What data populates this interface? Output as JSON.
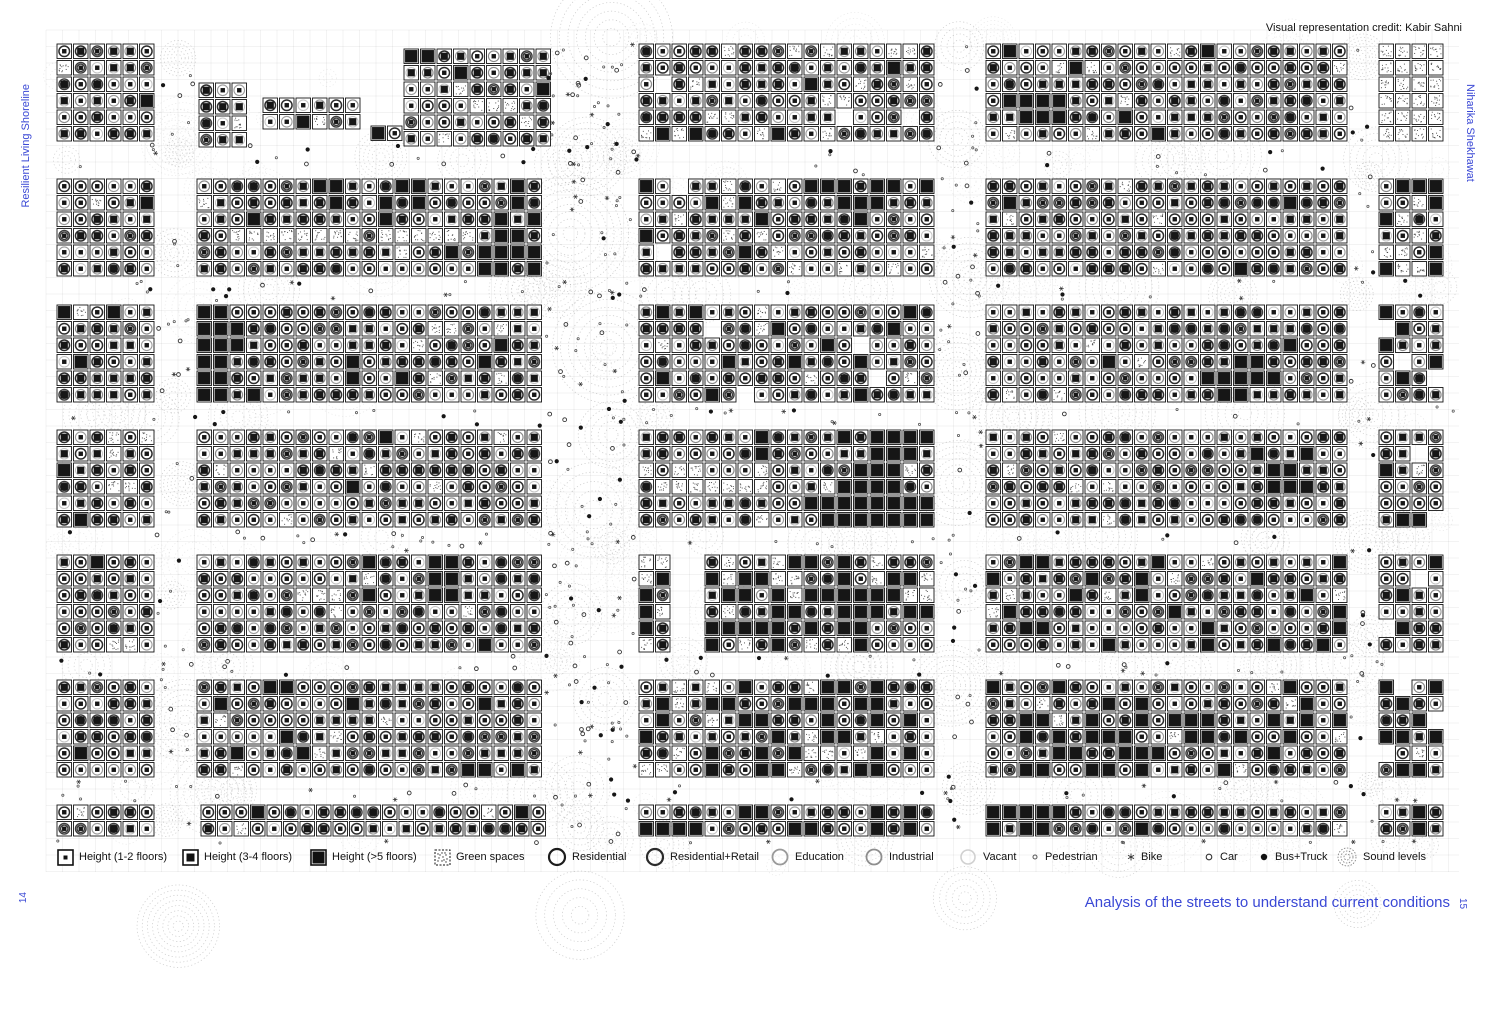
{
  "colors": {
    "accent": "#3a48d5",
    "ink": "#141414"
  },
  "page": {
    "credit": "Visual representation credit: Kabir Sahni",
    "margin_left_text": "Resilient Living Shoreline",
    "margin_right_text": "Niharika Shekhawat",
    "page_number_left": "14",
    "page_number_right": "15",
    "caption": "Analysis of the streets to understand current conditions"
  },
  "legend": {
    "items": [
      {
        "label": "Height (1-2 floors)",
        "icon": "height-low",
        "x": 57
      },
      {
        "label": "Height (3-4 floors)",
        "icon": "height-mid",
        "x": 182
      },
      {
        "label": "Height (>5 floors)",
        "icon": "height-high",
        "x": 310
      },
      {
        "label": "Green spaces",
        "icon": "green-spaces",
        "x": 434
      },
      {
        "label": "Residential",
        "icon": "residential",
        "x": 547
      },
      {
        "label": "Residential+Retail",
        "icon": "residential-retail",
        "x": 645
      },
      {
        "label": "Education",
        "icon": "education",
        "x": 770
      },
      {
        "label": "Industrial",
        "icon": "industrial",
        "x": 864
      },
      {
        "label": "Vacant",
        "icon": "vacant",
        "x": 958
      },
      {
        "label": "Pedestrian",
        "icon": "pedestrian",
        "x": 1030
      },
      {
        "label": "Bike",
        "icon": "bike",
        "x": 1126
      },
      {
        "label": "Car",
        "icon": "car",
        "x": 1203
      },
      {
        "label": "Bus+Truck",
        "icon": "bus-truck",
        "x": 1258
      },
      {
        "label": "Sound levels",
        "icon": "sound-levels",
        "x": 1336
      }
    ]
  },
  "map": {
    "width": 1498,
    "height": 1017,
    "cell": 16.5,
    "seed": 20240608,
    "grid": {
      "x0": 46,
      "y0": 30,
      "x1": 1459,
      "y1": 872
    },
    "colors": {
      "ink": "#161616",
      "grid": "rgba(20,20,20,0.10)",
      "sound": "#8a8a8a",
      "speckle": "#2f2f2f"
    },
    "defaults": {
      "green": 0.035,
      "tall": 0.045,
      "mid": 0.47
    },
    "ring_styles": [
      {
        "p": 0.38,
        "c": "#2d2d2d",
        "w": 1.5,
        "d": false
      },
      {
        "p": 0.18,
        "c": "#3c3c3c",
        "w": 1.4,
        "d": true
      },
      {
        "p": 0.16,
        "c": "#8a8a8a",
        "w": 1.2,
        "d": false
      },
      {
        "p": 0.16,
        "c": "#9c9c9c",
        "w": 1.1,
        "d": false
      },
      {
        "p": 0.12,
        "c": "#c4c4c4",
        "w": 1.0,
        "d": false
      }
    ],
    "ambient": {
      "count": 150,
      "alpha": 0.2
    },
    "street_alpha": 0.45,
    "vstreets": [
      {
        "x0": 155,
        "x1": 196,
        "gap": 110,
        "dots": 40
      },
      {
        "x0": 543,
        "x1": 638,
        "gap": 95,
        "dots": 150
      },
      {
        "x0": 935,
        "x1": 985,
        "gap": 105,
        "dots": 60
      },
      {
        "x0": 1348,
        "x1": 1378,
        "gap": 120,
        "dots": 28
      }
    ],
    "hstreets": [
      {
        "y0": 142,
        "y1": 178,
        "n": 10,
        "dots": 40
      },
      {
        "y0": 277,
        "y1": 304,
        "n": 10,
        "dots": 40
      },
      {
        "y0": 403,
        "y1": 429,
        "n": 10,
        "dots": 40
      },
      {
        "y0": 528,
        "y1": 554,
        "n": 10,
        "dots": 40
      },
      {
        "y0": 653,
        "y1": 679,
        "n": 10,
        "dots": 40
      },
      {
        "y0": 778,
        "y1": 804,
        "n": 10,
        "dots": 40
      },
      {
        "y0": 838,
        "y1": 846,
        "n": 6,
        "dots": 14
      }
    ],
    "blocks": [
      {
        "x": 56,
        "y": 43,
        "c": 6,
        "r": 6
      },
      {
        "x": 198,
        "y": 82,
        "c": 3,
        "r": 4
      },
      {
        "x": 262,
        "y": 97,
        "c": 6,
        "r": 2
      },
      {
        "x": 370,
        "y": 125,
        "c": 2,
        "r": 1
      },
      {
        "x": 403,
        "y": 48,
        "c": 9,
        "r": 6,
        "t": 0.12,
        "clusters": [
          {
            "c": 0,
            "r": 0,
            "w": 2,
            "h": 2,
            "k": "tall",
            "d": 0.7
          },
          {
            "c": 4,
            "r": 3,
            "w": 3,
            "h": 1,
            "k": "green",
            "d": 0.8
          }
        ]
      },
      {
        "x": 638,
        "y": 43,
        "c": 18,
        "r": 6,
        "g": 0.12,
        "t": 0.1,
        "holes": 3
      },
      {
        "x": 985,
        "y": 43,
        "c": 22,
        "r": 6,
        "t": 0.06,
        "clusters": [
          {
            "c": 1,
            "r": 3,
            "w": 4,
            "h": 2,
            "k": "tall",
            "d": 0.95
          }
        ]
      },
      {
        "x": 1378,
        "y": 43,
        "c": 4,
        "r": 6,
        "g": 1
      },
      {
        "x": 56,
        "y": 178,
        "c": 6,
        "r": 6
      },
      {
        "x": 196,
        "y": 178,
        "c": 21,
        "r": 6,
        "clusters": [
          {
            "c": 2,
            "r": 3,
            "w": 16,
            "h": 1,
            "k": "green",
            "d": 0.95
          },
          {
            "c": 6,
            "r": 0,
            "w": 3,
            "h": 2,
            "k": "tall",
            "d": 0.6
          },
          {
            "c": 11,
            "r": 0,
            "w": 3,
            "h": 2,
            "k": "tall",
            "d": 0.6
          },
          {
            "c": 17,
            "r": 2,
            "w": 4,
            "h": 4,
            "k": "tall",
            "d": 0.5
          }
        ]
      },
      {
        "x": 638,
        "y": 178,
        "c": 18,
        "r": 6,
        "t": 0.1,
        "g": 0.08,
        "holes": 2,
        "clusters": [
          {
            "c": 10,
            "r": 0,
            "w": 6,
            "h": 2,
            "k": "tall",
            "d": 0.5
          }
        ]
      },
      {
        "x": 985,
        "y": 178,
        "c": 22,
        "r": 6,
        "t": 0.05,
        "g": 0.04
      },
      {
        "x": 1378,
        "y": 178,
        "c": 4,
        "r": 6,
        "t": 0.3,
        "g": 0.3
      },
      {
        "x": 56,
        "y": 304,
        "c": 6,
        "r": 6
      },
      {
        "x": 196,
        "y": 304,
        "c": 21,
        "r": 6,
        "clusters": [
          {
            "c": 0,
            "r": 0,
            "w": 2,
            "h": 6,
            "k": "tall",
            "d": 0.85
          },
          {
            "c": 2,
            "r": 1,
            "w": 1,
            "h": 3,
            "k": "tall",
            "d": 0.6
          },
          {
            "c": 14,
            "r": 1,
            "w": 4,
            "h": 1,
            "k": "green",
            "d": 0.7
          }
        ]
      },
      {
        "x": 638,
        "y": 304,
        "c": 18,
        "r": 6,
        "holes": 4,
        "t": 0.08,
        "g": 0.06,
        "clusters": [
          {
            "c": 1,
            "r": 0,
            "w": 2,
            "h": 2,
            "k": "tall",
            "d": 0.6
          }
        ]
      },
      {
        "x": 985,
        "y": 304,
        "c": 22,
        "r": 6,
        "clusters": [
          {
            "c": 13,
            "r": 3,
            "w": 4,
            "h": 3,
            "k": "tall",
            "d": 0.8
          }
        ]
      },
      {
        "x": 1378,
        "y": 304,
        "c": 4,
        "r": 6,
        "holes": 3,
        "t": 0.2
      },
      {
        "x": 56,
        "y": 429,
        "c": 6,
        "r": 6
      },
      {
        "x": 196,
        "y": 429,
        "c": 21,
        "r": 6,
        "t": 0.04,
        "g": 0.05
      },
      {
        "x": 638,
        "y": 429,
        "c": 18,
        "r": 6,
        "g": 0.12,
        "clusters": [
          {
            "c": 12,
            "r": 0,
            "w": 6,
            "h": 2,
            "k": "tall",
            "d": 0.85
          },
          {
            "c": 13,
            "r": 2,
            "w": 3,
            "h": 2,
            "k": "tall",
            "d": 0.7
          },
          {
            "c": 11,
            "r": 4,
            "w": 7,
            "h": 2,
            "k": "tall",
            "d": 0.8
          },
          {
            "c": 2,
            "r": 2,
            "w": 6,
            "h": 2,
            "k": "green",
            "d": 0.8
          }
        ]
      },
      {
        "x": 985,
        "y": 429,
        "c": 22,
        "r": 6,
        "clusters": [
          {
            "c": 16,
            "r": 1,
            "w": 4,
            "h": 3,
            "k": "tall",
            "d": 0.7
          }
        ]
      },
      {
        "x": 1378,
        "y": 429,
        "c": 4,
        "r": 6,
        "holes": 2,
        "t": 0.15
      },
      {
        "x": 56,
        "y": 554,
        "c": 6,
        "r": 6
      },
      {
        "x": 196,
        "y": 554,
        "c": 21,
        "r": 6,
        "clusters": [
          {
            "c": 14,
            "r": 0,
            "w": 2,
            "h": 3,
            "k": "tall",
            "d": 0.9
          },
          {
            "c": 4,
            "r": 2,
            "w": 6,
            "h": 1,
            "k": "green",
            "d": 0.6
          }
        ]
      },
      {
        "x": 638,
        "y": 554,
        "c": 2,
        "r": 6,
        "g": 0.6,
        "t": 0.2
      },
      {
        "x": 704,
        "y": 554,
        "c": 14,
        "r": 6,
        "t": 0.5,
        "g": 0.15,
        "clusters": [
          {
            "c": 10,
            "r": 4,
            "w": 4,
            "h": 2,
            "k": "low"
          }
        ]
      },
      {
        "x": 985,
        "y": 554,
        "c": 22,
        "r": 6,
        "t": 0.18,
        "g": 0.04
      },
      {
        "x": 1378,
        "y": 554,
        "c": 4,
        "r": 6,
        "t": 0.25,
        "holes": 2
      },
      {
        "x": 56,
        "y": 679,
        "c": 6,
        "r": 6
      },
      {
        "x": 196,
        "y": 679,
        "c": 21,
        "r": 6,
        "t": 0.06,
        "clusters": [
          {
            "c": 1,
            "r": 4,
            "w": 2,
            "h": 1,
            "k": "tall",
            "d": 0.9
          }
        ]
      },
      {
        "x": 638,
        "y": 679,
        "c": 18,
        "r": 6,
        "t": 0.25,
        "g": 0.1
      },
      {
        "x": 985,
        "y": 679,
        "c": 22,
        "r": 6,
        "t": 0.3,
        "g": 0.05
      },
      {
        "x": 1378,
        "y": 679,
        "c": 4,
        "r": 6,
        "t": 0.2,
        "holes": 3
      },
      {
        "x": 56,
        "y": 804,
        "c": 6,
        "r": 2
      },
      {
        "x": 200,
        "y": 804,
        "c": 21,
        "r": 2,
        "t": 0.05,
        "g": 0.03
      },
      {
        "x": 638,
        "y": 804,
        "c": 18,
        "r": 2,
        "t": 0.3
      },
      {
        "x": 985,
        "y": 804,
        "c": 22,
        "r": 2,
        "clusters": [
          {
            "c": 0,
            "r": 0,
            "w": 4,
            "h": 2,
            "k": "tall",
            "d": 0.9
          }
        ]
      },
      {
        "x": 1378,
        "y": 804,
        "c": 4,
        "r": 2,
        "t": 0.3
      }
    ]
  }
}
